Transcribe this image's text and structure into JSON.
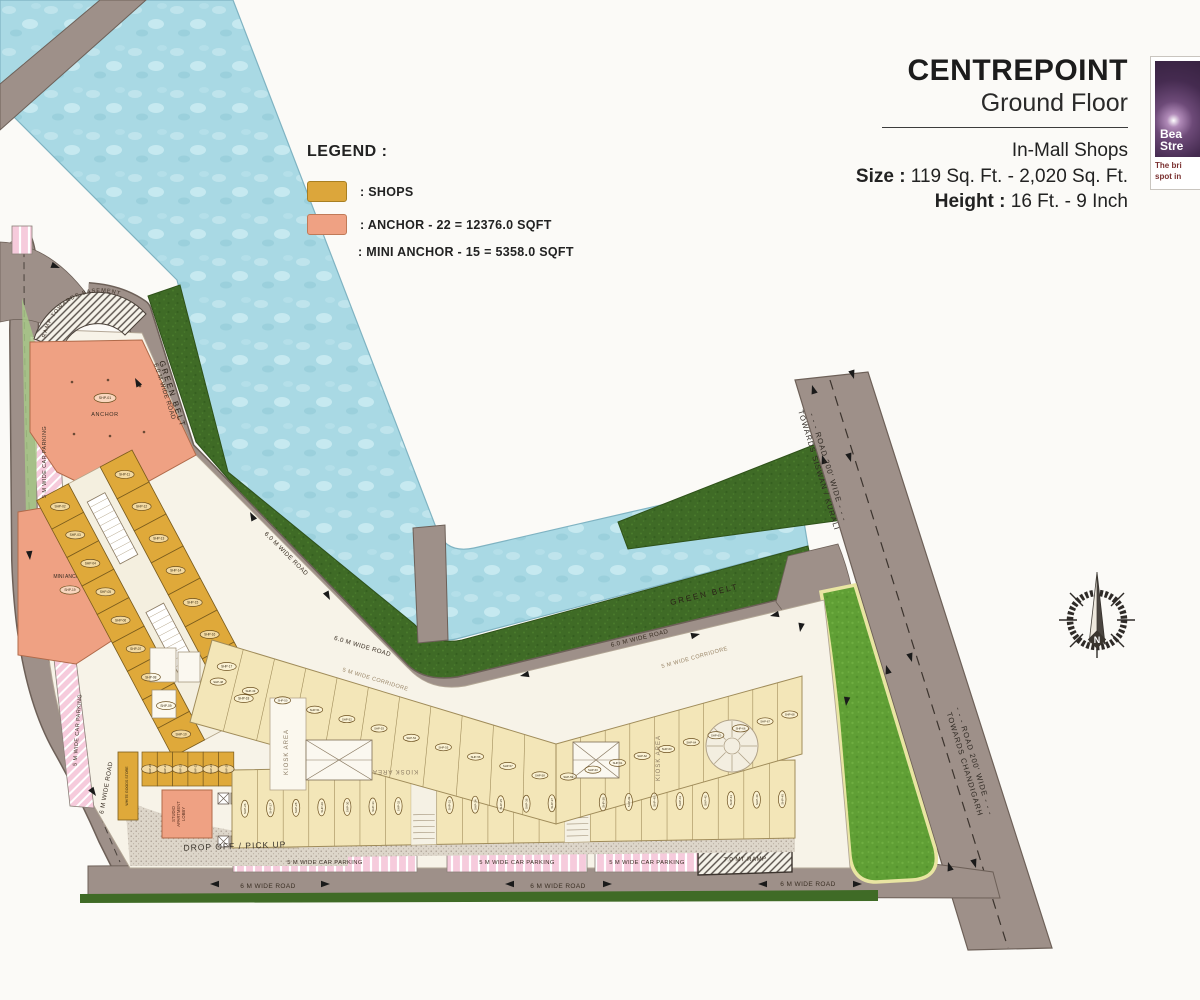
{
  "header": {
    "title": "CENTREPOINT",
    "subtitle": "Ground Floor",
    "line3": "In-Mall Shops",
    "size_label": "Size :",
    "size_value": "119 Sq. Ft. - 2,020 Sq. Ft.",
    "height_label": "Height :",
    "height_value": "16 Ft. - 9 Inch"
  },
  "logo": {
    "line1": "Bea",
    "line2": "Stre",
    "caption1": "The bri",
    "caption2": "spot in"
  },
  "legend": {
    "title": "LEGEND :",
    "items": [
      {
        "swatch": "#DCA63B",
        "border": "#a87f22",
        "label": ": SHOPS"
      },
      {
        "swatch": "#EFA183",
        "border": "#c07a58",
        "label": ": ANCHOR - 22 =  12376.0 SQFT"
      },
      {
        "swatch": "",
        "border": "",
        "label": ": MINI ANCHOR - 15 = 5358.0 SQFT"
      }
    ]
  },
  "plan": {
    "labels": {
      "green_belt": "GREEN BELT",
      "road_6_0": "6.0 M WIDE ROAD",
      "road_6": "6 M WIDE ROAD",
      "parking_5": "5 M WIDE CAR PARKING",
      "corridor": "5 M WIDE CORRIDORE",
      "road_200": "- - - ROAD 200' WIDE - - -",
      "towards_siswan": "TOWARDS SISWAN / KURALI",
      "towards_chandigarh": "TOWARDS CHANDIGARH",
      "drop_off": "DROP OFF / PICK UP",
      "ramp7": "7.0 MT RAMP",
      "ramp_basement": "RAMP TOWARDS BASEMENT",
      "anchor": "ANCHOR",
      "mini_anchor": "MINI ANCHOR",
      "studio_lobby_1": "STUDIO",
      "studio_lobby_2": "APARTMENT",
      "studio_lobby_3": "LOBBY",
      "white_goods": "WHITE GOODS STORE",
      "kiosk": "KIOSK AREA",
      "atrium": "ATRIUM",
      "north": "N"
    },
    "shops": {
      "prefix": "SHP-",
      "groups": {
        "anchor": {
          "start": 1,
          "count": 1
        },
        "left_outer": {
          "start": 2,
          "count": 9
        },
        "left_inner": {
          "start": 11,
          "count": 8
        },
        "mini": {
          "start": 19,
          "count": 1
        },
        "entry_row": {
          "start": 20,
          "count": 6
        },
        "bottom_row": {
          "start": 26,
          "count": 22
        },
        "fan_left": {
          "start": 48,
          "count": 11
        },
        "fan_right": {
          "start": 59,
          "count": 10
        }
      }
    },
    "colors": {
      "water": "#a9d9e4",
      "green_belt": "#3f6b26",
      "lawn": "#609f35",
      "road": "#9e9089",
      "road_edge": "#6d6058",
      "shop_bright": "#dfa93a",
      "shop_pale": "#f3e6b8",
      "anchor_fill": "#efa183",
      "pink": "#f6cbdc",
      "slab": "#f7f3e8",
      "label_ink": "#3a2f24"
    }
  }
}
